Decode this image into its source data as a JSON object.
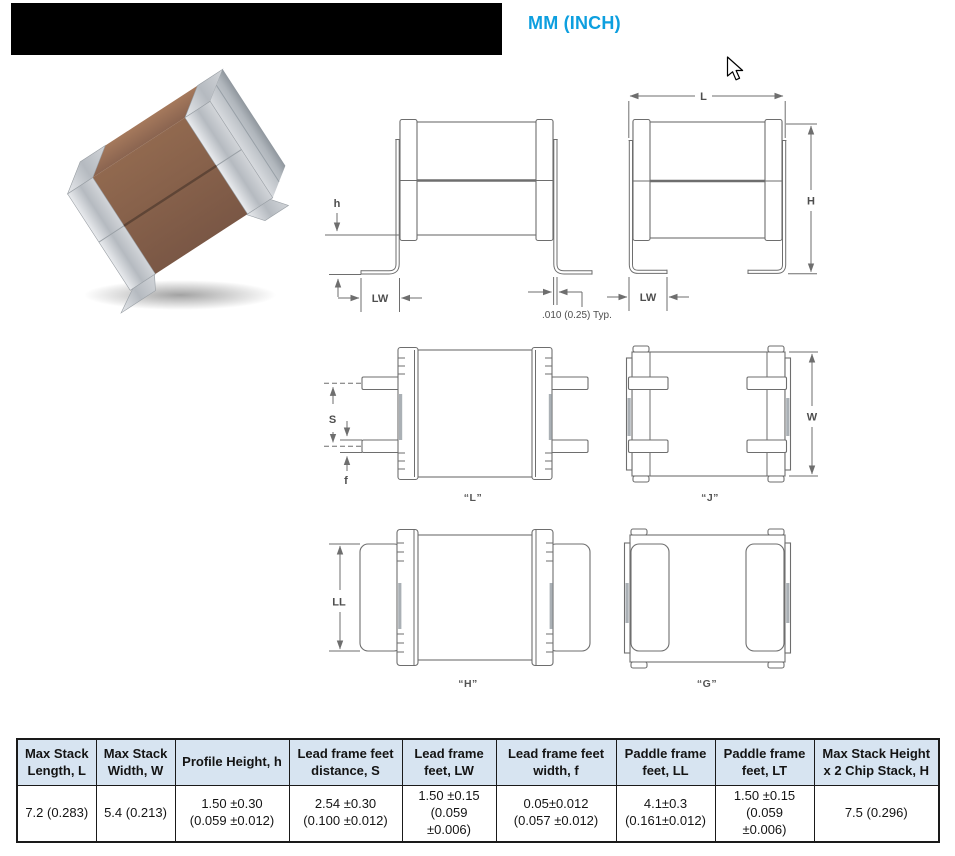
{
  "header": {
    "units_label": "MM (INCH)",
    "accent_color": "#0d9fdf",
    "redacted_title": true
  },
  "figure": {
    "photo_name": "stacked-chip-capacitor-3d-render",
    "body_color": "#8a6450",
    "terminal_color": "#c3c7cc"
  },
  "drawings": {
    "front_l": {
      "h": "h",
      "lw": "LW",
      "typ_note": ".010 (0.25) Typ."
    },
    "front_j": {
      "l": "L",
      "h": "H",
      "lw": "LW"
    },
    "top_l": {
      "s": "S",
      "f": "f",
      "caption": "“L”"
    },
    "top_j": {
      "w": "W",
      "caption": "“J”"
    },
    "top_h": {
      "ll": "LL",
      "caption": "“H”"
    },
    "top_g": {
      "caption": "“G”"
    }
  },
  "table": {
    "columns": [
      "Max Stack Length, L",
      "Max Stack Width, W",
      "Profile Height, h",
      "Lead frame feet distance, S",
      "Lead frame feet, LW",
      "Lead frame feet width, f",
      "Paddle frame feet, LL",
      "Paddle frame feet, LT",
      "Max Stack Height x 2 Chip Stack, H"
    ],
    "row": [
      [
        "7.2 (0.283)"
      ],
      [
        "5.4 (0.213)"
      ],
      [
        "1.50 ±0.30",
        "(0.059 ±0.012)"
      ],
      [
        "2.54 ±0.30",
        "(0.100 ±0.012)"
      ],
      [
        "1.50 ±0.15",
        "(0.059",
        "±0.006)"
      ],
      [
        "0.05±0.012",
        "(0.057 ±0.012)"
      ],
      [
        "4.1±0.3",
        "(0.161±0.012)"
      ],
      [
        "1.50 ±0.15",
        "(0.059",
        "±0.006)"
      ],
      [
        "7.5 (0.296)"
      ]
    ],
    "header_bg": "#d7e4f1"
  }
}
